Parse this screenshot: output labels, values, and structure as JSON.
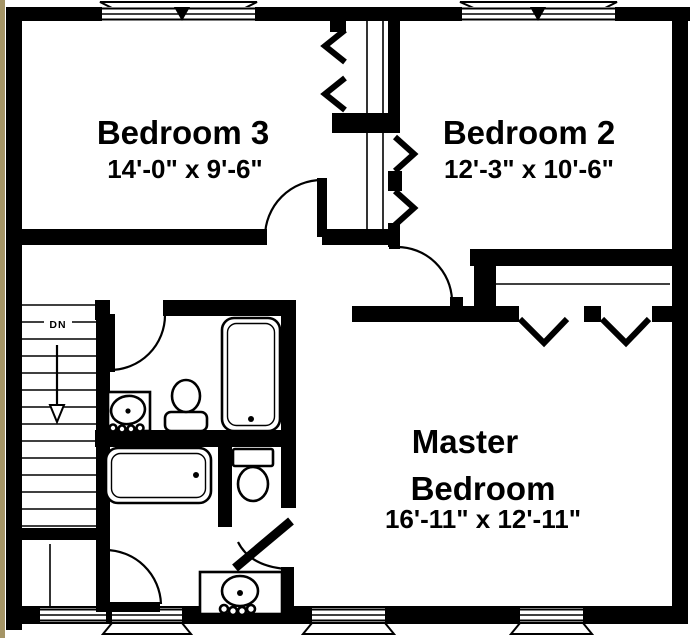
{
  "plan": {
    "type": "floor-plan",
    "rooms": {
      "bedroom3": {
        "name": "Bedroom 3",
        "dims": "14'-0\" x 9'-6\""
      },
      "bedroom2": {
        "name": "Bedroom 2",
        "dims": "12'-3\" x 10'-6\""
      },
      "master": {
        "name_line1": "Master",
        "name_line2": "Bedroom",
        "dims": "16'-11\" x 12'-11\""
      }
    },
    "stairs": {
      "direction_label": "DN"
    },
    "fixtures": {
      "hall_bathroom": [
        "sink-vanity-icon",
        "toilet-icon",
        "bathtub-icon"
      ],
      "master_bathroom": [
        "bathtub-icon",
        "toilet-icon",
        "sink-vanity-icon"
      ]
    },
    "colors": {
      "wall": "#000000",
      "floor": "#ffffff",
      "scan_edge": "#a59566"
    }
  }
}
